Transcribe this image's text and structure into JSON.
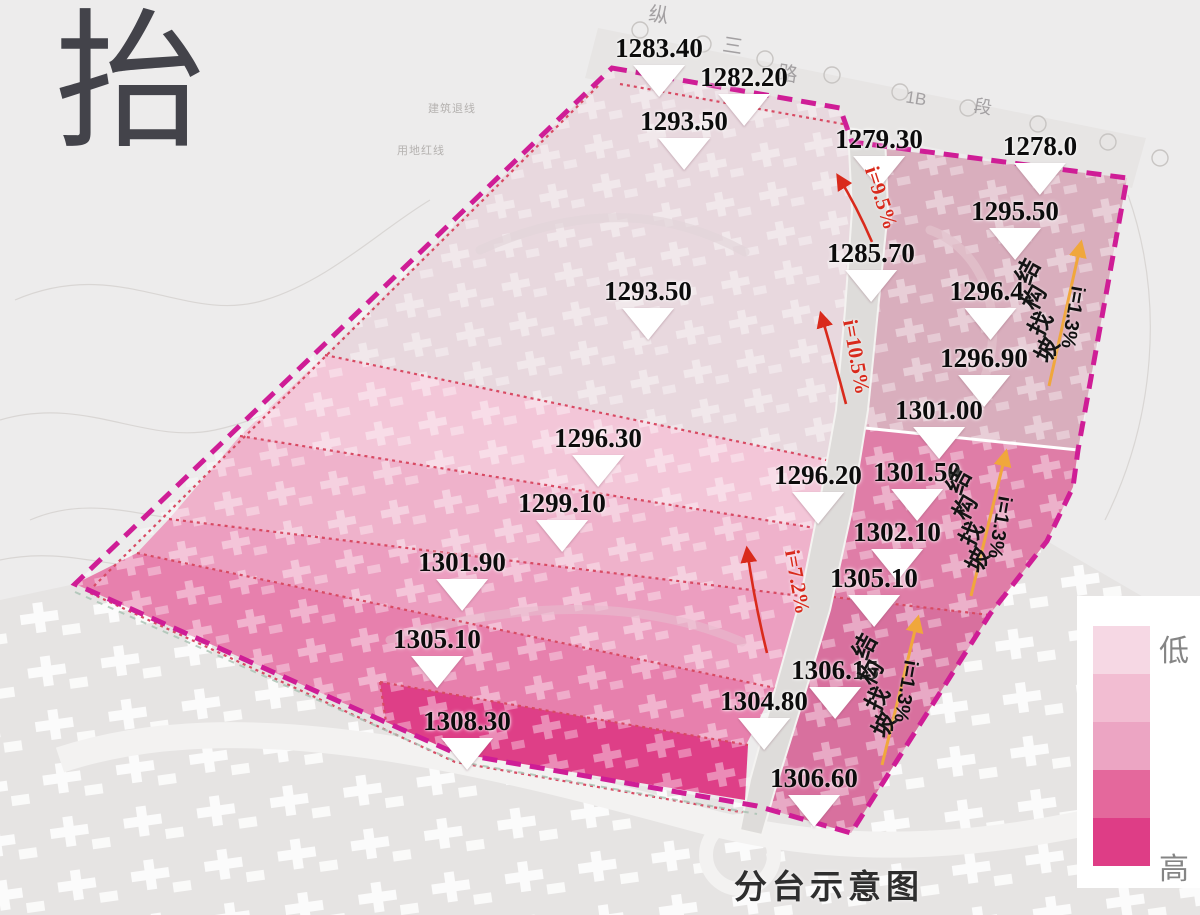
{
  "page": {
    "big_character": "抬",
    "title": "分台示意图"
  },
  "legend": {
    "low_label": "低",
    "high_label": "高",
    "colors": [
      "#f6d8e4",
      "#f2bdd2",
      "#eca5c3",
      "#e4689c",
      "#de3d86"
    ]
  },
  "colors": {
    "bg": "#edecec",
    "boundary": "#cf1d96",
    "separator": "#d84a63",
    "slope_red": "#d92a1c",
    "arrow_orange": "#f0a73c",
    "road": "#dedcda",
    "zoneA": "#e8d8de",
    "zoneB": "#f3c6d8",
    "zoneC": "#efb2cb",
    "zoneD": "#ec9ec0",
    "zoneE": "#e780ad",
    "zoneF": "#de3f87",
    "zoneG": "#d9aebd",
    "zoneH": "#df7da7",
    "zoneI": "#d8709e",
    "bottom_map": "#e6e4e3"
  },
  "markers": [
    {
      "value": "1283.40",
      "x": 659,
      "y": 33
    },
    {
      "value": "1282.20",
      "x": 744,
      "y": 62
    },
    {
      "value": "1293.50",
      "x": 684,
      "y": 106
    },
    {
      "value": "1279.30",
      "x": 879,
      "y": 124
    },
    {
      "value": "1278.0",
      "x": 1040,
      "y": 131
    },
    {
      "value": "1295.50",
      "x": 1015,
      "y": 196
    },
    {
      "value": "1285.70",
      "x": 871,
      "y": 238
    },
    {
      "value": "1293.50",
      "x": 648,
      "y": 276
    },
    {
      "value": "1296.4.",
      "x": 990,
      "y": 276
    },
    {
      "value": "1296.90",
      "x": 984,
      "y": 343
    },
    {
      "value": "1301.00",
      "x": 939,
      "y": 395
    },
    {
      "value": "1296.30",
      "x": 598,
      "y": 423
    },
    {
      "value": "1301.50",
      "x": 917,
      "y": 457
    },
    {
      "value": "1296.20",
      "x": 818,
      "y": 460
    },
    {
      "value": "1299.10",
      "x": 562,
      "y": 488
    },
    {
      "value": "1302.10",
      "x": 897,
      "y": 517
    },
    {
      "value": "1301.90",
      "x": 462,
      "y": 547
    },
    {
      "value": "1305.10",
      "x": 874,
      "y": 563
    },
    {
      "value": "1305.10",
      "x": 437,
      "y": 624
    },
    {
      "value": "1306.15",
      "x": 835,
      "y": 655
    },
    {
      "value": "1304.80",
      "x": 764,
      "y": 686
    },
    {
      "value": "1308.30",
      "x": 467,
      "y": 706
    },
    {
      "value": "1306.60",
      "x": 814,
      "y": 763
    }
  ],
  "slope_labels": [
    {
      "text": "i=9.5%",
      "x": 881,
      "y": 198,
      "angle": 72
    },
    {
      "text": "i=10.5%",
      "x": 856,
      "y": 357,
      "angle": 80
    },
    {
      "text": "i=7.2%",
      "x": 797,
      "y": 582,
      "angle": 80
    }
  ],
  "structure_slopes": [
    {
      "label": "结构找坡",
      "slope": "i=1.3%",
      "x": 1038,
      "y": 311,
      "ix": 1072,
      "iy": 317
    },
    {
      "label": "结构找坡",
      "slope": "i=1.3%",
      "x": 969,
      "y": 521,
      "ix": 999,
      "iy": 527
    },
    {
      "label": "结构找坡",
      "slope": "i=1.3%",
      "x": 875,
      "y": 686,
      "ix": 905,
      "iy": 691
    }
  ],
  "road_labels": [
    {
      "text": "纵",
      "x": 659,
      "y": 13,
      "size": 20
    },
    {
      "text": "三",
      "x": 733,
      "y": 44,
      "size": 20
    },
    {
      "text": "路",
      "x": 788,
      "y": 72,
      "size": 20
    },
    {
      "text": "1B",
      "x": 916,
      "y": 99,
      "size": 17
    },
    {
      "text": "段",
      "x": 983,
      "y": 106,
      "size": 18
    }
  ],
  "site_notes": [
    {
      "text": "建筑退线",
      "x": 452,
      "y": 108
    },
    {
      "text": "用地红线",
      "x": 421,
      "y": 150
    }
  ]
}
